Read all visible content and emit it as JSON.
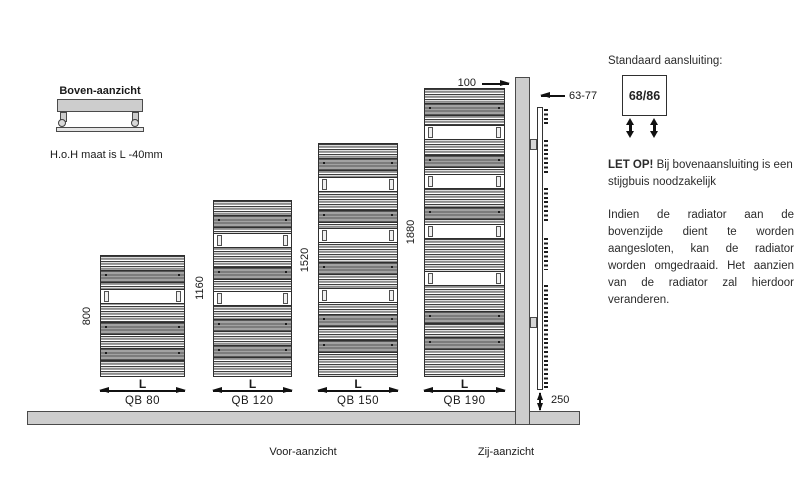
{
  "colors": {
    "gray_fill": "#cdcdcd",
    "outline": "#3f3f3f",
    "text": "#1a1a1a"
  },
  "top_view": {
    "title": "Boven-aanzicht",
    "note": "H.o.H  maat is L -40mm"
  },
  "front_view": {
    "caption": "Voor-aanzicht",
    "dim_label": "L",
    "radiators": [
      {
        "model": "QB 80",
        "height_mm": "800"
      },
      {
        "model": "QB 120",
        "height_mm": "1160"
      },
      {
        "model": "QB 150",
        "height_mm": "1520"
      },
      {
        "model": "QB 190",
        "height_mm": "1880"
      }
    ]
  },
  "side_view": {
    "caption": "Zij-aanzicht",
    "wall_distance_mm": "100",
    "depth_mm": "63-77",
    "floor_clearance_mm": "250"
  },
  "connection": {
    "title": "Standaard aansluiting:",
    "size_label": "68/86"
  },
  "notes": {
    "warning_bold": "LET OP!",
    "warning_rest": " Bij bovenaansluiting is een stijgbuis noodzakelijk",
    "body": "Indien de radiator aan de bovenzijde dient te worden aangesloten, kan de radiator worden omgedraaid. Het aanzien van de radiator zal hierdoor veranderen."
  }
}
